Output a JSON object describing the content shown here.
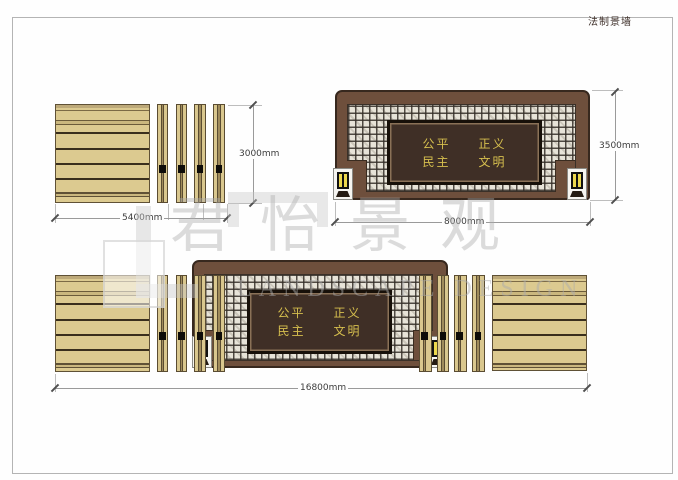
{
  "title": "法制景墙",
  "watermark": {
    "cn": "君怡景观",
    "en": "LANDSCAPE DESIGN"
  },
  "plaque": {
    "line1": "公平　　正义",
    "line2": "民主　　文明"
  },
  "dimensions": {
    "side_panel_width": "5400mm",
    "side_panel_height": "3000mm",
    "feature_wall_width": "8000mm",
    "feature_wall_height": "3500mm",
    "total_width": "16800mm"
  },
  "colors": {
    "wood_tan": "#dcca90",
    "wood_line": "#3a2f1d",
    "wall_brown": "#6e4f3c",
    "wall_border": "#37281e",
    "plaque_bg": "#3f2f26",
    "plaque_gold": "#d6bf4e",
    "lattice_light": "#e7e3d8",
    "lattice_dark": "#3a342c",
    "lantern_yellow": "#ecd84e",
    "dim_line": "#9a9a9a",
    "dim_text": "#3c3c3c",
    "watermark_gray": "#acacac"
  }
}
